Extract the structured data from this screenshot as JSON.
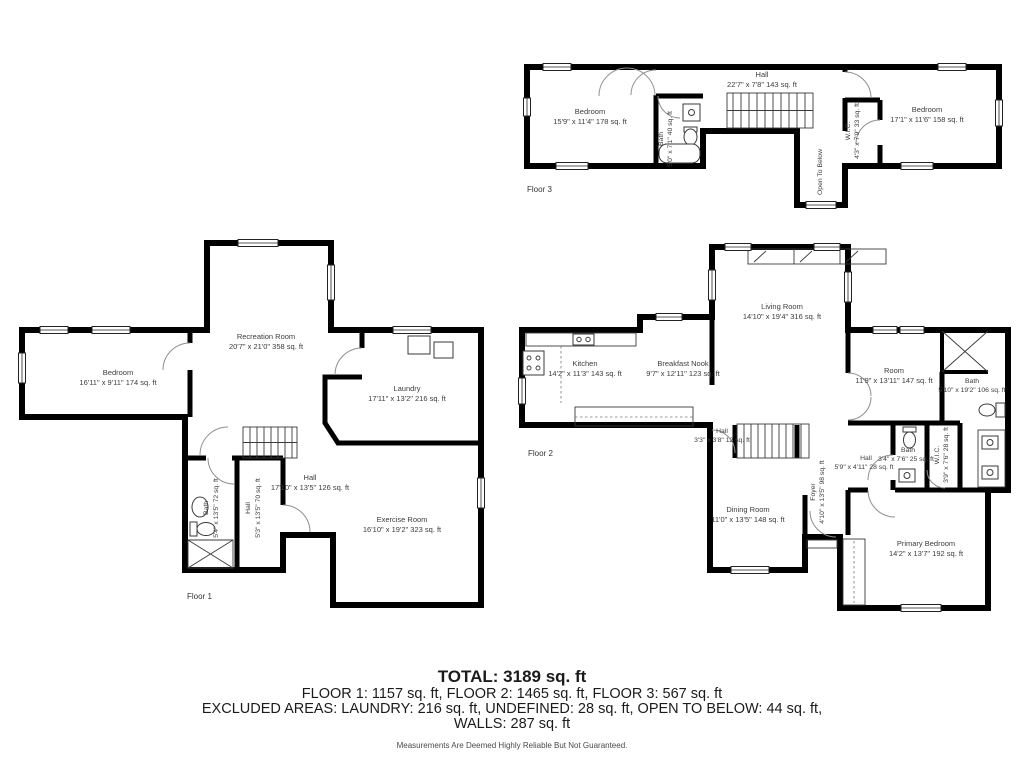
{
  "colors": {
    "walls": "#000000",
    "label_text": "#3c3c3c"
  },
  "floors": {
    "f1": {
      "caption": "Floor 1",
      "rooms": {
        "recreation": {
          "name": "Recreation Room",
          "dims": "20'7\" x 21'0\" 358 sq. ft"
        },
        "bedroom": {
          "name": "Bedroom",
          "dims": "16'11\" x 9'11\" 174 sq. ft"
        },
        "laundry": {
          "name": "Laundry",
          "dims": "17'11\" x 13'2\" 216 sq. ft"
        },
        "hall": {
          "name": "Hall",
          "dims": "17'10\" x 13'5\" 126 sq. ft"
        },
        "bath": {
          "name": "Bath",
          "dims": "5'4\" x 13'5\" 72 sq. ft"
        },
        "hall_side": {
          "name": "Hall",
          "dims": "5'3\" x 13'5\" 70 sq. ft"
        },
        "exercise": {
          "name": "Exercise Room",
          "dims": "16'10\" x 19'2\" 323 sq. ft"
        }
      }
    },
    "f2": {
      "caption": "Floor 2",
      "rooms": {
        "living": {
          "name": "Living Room",
          "dims": "14'10\" x 19'4\" 316 sq. ft"
        },
        "kitchen": {
          "name": "Kitchen",
          "dims": "14'2\" x 11'3\" 143 sq. ft"
        },
        "nook": {
          "name": "Breakfast Nook",
          "dims": "9'7\" x 12'11\" 123 sq. ft"
        },
        "room": {
          "name": "Room",
          "dims": "11'9\" x 13'11\" 147 sq. ft"
        },
        "bath_main": {
          "name": "Bath",
          "dims": "5'10\" x 19'2\" 106 sq. ft"
        },
        "hall_small": {
          "name": "Hall",
          "dims": "3'3\" x 3'8\" 12 sq. ft"
        },
        "dining": {
          "name": "Dining Room",
          "dims": "11'0\" x 13'5\" 148 sq. ft"
        },
        "foyer": {
          "name": "Foyer",
          "dims": "4'10\" x 13'5\" 98 sq. ft"
        },
        "hall": {
          "name": "Hall",
          "dims": "5'9\" x 4'11\" 28 sq. ft"
        },
        "bath_small": {
          "name": "Bath",
          "dims": "3'4\" x 7'6\" 25 sq. ft"
        },
        "wic": {
          "name": "W.I.C.",
          "dims": "3'9\" x 7'6\" 28 sq. ft"
        },
        "primary": {
          "name": "Primary Bedroom",
          "dims": "14'2\" x 13'7\" 192 sq. ft"
        }
      }
    },
    "f3": {
      "caption": "Floor 3",
      "rooms": {
        "bedroom_left": {
          "name": "Bedroom",
          "dims": "15'9\" x 11'4\" 178 sq. ft"
        },
        "bath": {
          "name": "Bath",
          "dims": "5'0\" x 7'1\" 40 sq. ft"
        },
        "hall": {
          "name": "Hall",
          "dims": "22'7\" x 7'8\" 143 sq. ft"
        },
        "open_below": {
          "name": "Open To Below"
        },
        "wic": {
          "name": "W.I.C.",
          "dims": "4'3\" x 7'9\" 33 sq. ft"
        },
        "bedroom_right": {
          "name": "Bedroom",
          "dims": "17'1\" x 11'6\" 158 sq. ft"
        }
      }
    }
  },
  "summary": {
    "total": "TOTAL: 3189 sq. ft",
    "floors_line": "FLOOR 1: 1157 sq. ft, FLOOR 2: 1465 sq. ft, FLOOR 3: 567 sq. ft",
    "excluded_line": "EXCLUDED AREAS: LAUNDRY: 216 sq. ft, UNDEFINED: 28 sq. ft, OPEN TO BELOW: 44 sq. ft,",
    "walls_line": "WALLS: 287 sq. ft",
    "disclaimer": "Measurements Are Deemed Highly Reliable But Not Guaranteed."
  }
}
